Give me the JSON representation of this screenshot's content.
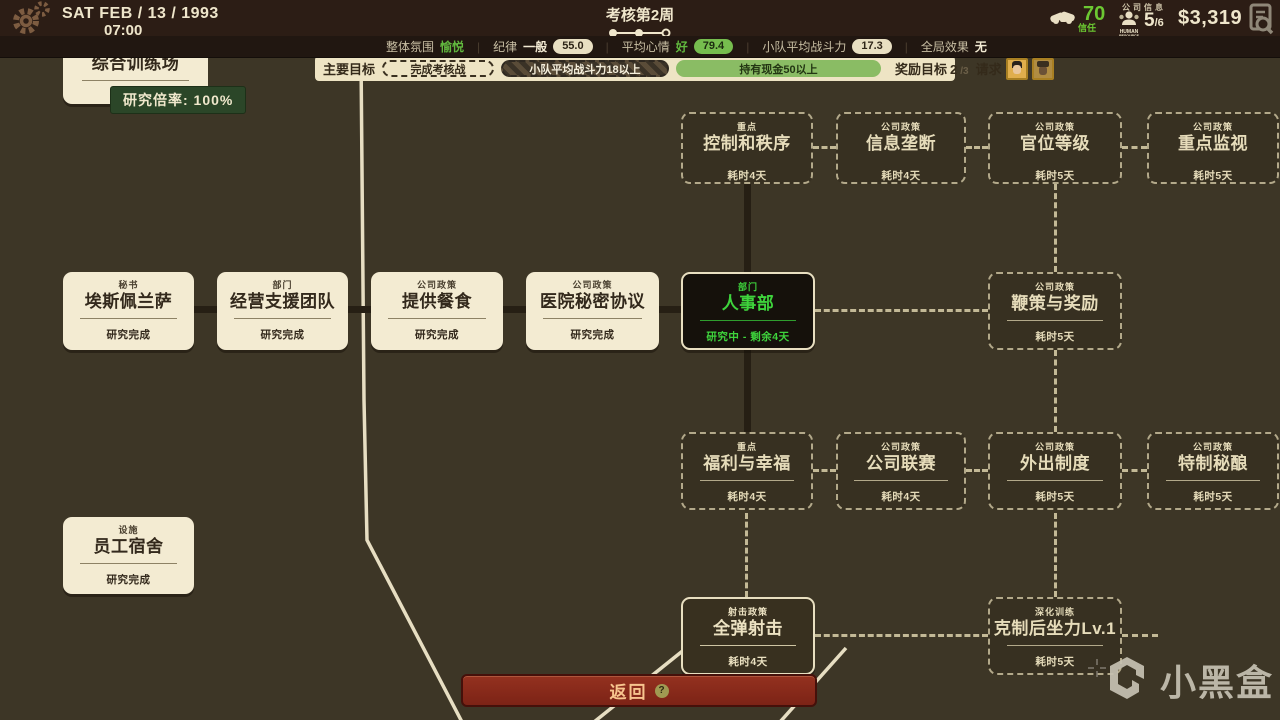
{
  "topbar": {
    "date": "SAT  FEB / 13 / 1993",
    "time": "07:00",
    "week_title": "考核第2周",
    "trust_value": "70",
    "trust_label": "信任",
    "company_info_label": "公司信息",
    "hr_icon_line1": "HUMAN",
    "hr_icon_line2": "RESOURCE",
    "hr_current": "5",
    "hr_max": "/6",
    "money": "$3,319"
  },
  "statsbar": {
    "items": [
      {
        "label": "整体氛围",
        "value": "愉悦",
        "value_class": "green"
      },
      {
        "label": "纪律",
        "value": "一般",
        "value_class": "white",
        "pill": "55.0",
        "pill_class": "cream"
      },
      {
        "label": "平均心情",
        "value": "好",
        "value_class": "green",
        "pill": "79.4",
        "pill_class": "green"
      },
      {
        "label": "小队平均战斗力",
        "pill": "17.3",
        "pill_class": "cream"
      },
      {
        "label": "全局效果",
        "value": "无",
        "value_class": "white"
      }
    ]
  },
  "objectives": {
    "title": "主要目标",
    "goals": [
      {
        "text": "完成考核战",
        "style": "dashed"
      },
      {
        "text": "小队平均战斗力18以上",
        "style": "hatched"
      },
      {
        "text": "持有现金50以上",
        "style": "green"
      }
    ],
    "reward_label": "奖励目标",
    "reward_current": "2",
    "reward_total": "/3",
    "request_label": "请求"
  },
  "tooltip": {
    "text": "研究倍率: 100%"
  },
  "nodes": [
    {
      "id": "zonghe-xunlianchang",
      "category": "",
      "title": "综合训练场",
      "status": "研究完成",
      "state": "done",
      "x": 63,
      "y": 34,
      "w": 145,
      "h": 70
    },
    {
      "id": "kongzhi-he-zhixu",
      "category": "重点",
      "title": "控制和秩序",
      "status": "耗时4天",
      "state": "locked",
      "x": 681,
      "y": 112,
      "w": 132,
      "h": 72
    },
    {
      "id": "xinxi-longduan",
      "category": "公司政策",
      "title": "信息垄断",
      "status": "耗时4天",
      "state": "locked",
      "x": 836,
      "y": 112,
      "w": 130,
      "h": 72
    },
    {
      "id": "guanwei-dengji",
      "category": "公司政策",
      "title": "官位等级",
      "status": "耗时5天",
      "state": "locked",
      "x": 988,
      "y": 112,
      "w": 134,
      "h": 72
    },
    {
      "id": "zhongdian-jianshi",
      "category": "公司政策",
      "title": "重点监视",
      "status": "耗时5天",
      "state": "locked",
      "x": 1147,
      "y": 112,
      "w": 132,
      "h": 72
    },
    {
      "id": "aisipeilansa",
      "category": "秘书",
      "title": "埃斯佩兰萨",
      "status": "研究完成",
      "state": "done",
      "x": 63,
      "y": 272,
      "w": 131,
      "h": 78
    },
    {
      "id": "jingying-zhiyuan-tuandui",
      "category": "部门",
      "title": "经营支援团队",
      "status": "研究完成",
      "state": "done",
      "x": 217,
      "y": 272,
      "w": 131,
      "h": 78
    },
    {
      "id": "tigong-canshi",
      "category": "公司政策",
      "title": "提供餐食",
      "status": "研究完成",
      "state": "done",
      "x": 371,
      "y": 272,
      "w": 132,
      "h": 78
    },
    {
      "id": "yiyuan-mimi-xieyi",
      "category": "公司政策",
      "title": "医院秘密协议",
      "status": "研究完成",
      "state": "done",
      "x": 526,
      "y": 272,
      "w": 133,
      "h": 78
    },
    {
      "id": "renshibu",
      "category": "部门",
      "title": "人事部",
      "status": "研究中 - 剩余4天",
      "state": "active",
      "x": 681,
      "y": 272,
      "w": 134,
      "h": 78
    },
    {
      "id": "biance-yu-jiangli",
      "category": "公司政策",
      "title": "鞭策与奖励",
      "status": "耗时5天",
      "state": "locked",
      "x": 988,
      "y": 272,
      "w": 134,
      "h": 78
    },
    {
      "id": "fuli-yu-xingfu",
      "category": "重点",
      "title": "福利与幸福",
      "status": "耗时4天",
      "state": "locked",
      "x": 681,
      "y": 432,
      "w": 132,
      "h": 78
    },
    {
      "id": "gongsi-liansai",
      "category": "公司政策",
      "title": "公司联赛",
      "status": "耗时4天",
      "state": "locked",
      "x": 836,
      "y": 432,
      "w": 130,
      "h": 78
    },
    {
      "id": "waichu-zhidu",
      "category": "公司政策",
      "title": "外出制度",
      "status": "耗时5天",
      "state": "locked",
      "x": 988,
      "y": 432,
      "w": 134,
      "h": 78
    },
    {
      "id": "tezhi-miniang",
      "category": "公司政策",
      "title": "特制秘酿",
      "status": "耗时5天",
      "state": "locked",
      "x": 1147,
      "y": 432,
      "w": 132,
      "h": 78
    },
    {
      "id": "yuangong-sushe",
      "category": "设施",
      "title": "员工宿舍",
      "status": "研究完成",
      "state": "done",
      "x": 63,
      "y": 517,
      "w": 131,
      "h": 77
    },
    {
      "id": "quandan-sheji",
      "category": "射击政策",
      "title": "全弹射击",
      "status": "耗时4天",
      "state": "available",
      "x": 681,
      "y": 597,
      "w": 134,
      "h": 78
    },
    {
      "id": "kezhi-houzuoli-lv1",
      "category": "深化训练",
      "title": "克制后坐力Lv.1",
      "status": "耗时5天",
      "state": "locked",
      "x": 988,
      "y": 597,
      "w": 134,
      "h": 78
    }
  ],
  "connectors": [
    {
      "o": "h",
      "x": 194,
      "y": 306,
      "len": 23,
      "style": "solid"
    },
    {
      "o": "h",
      "x": 348,
      "y": 306,
      "len": 23,
      "style": "solid"
    },
    {
      "o": "h",
      "x": 503,
      "y": 306,
      "len": 23,
      "style": "solid"
    },
    {
      "o": "h",
      "x": 659,
      "y": 306,
      "len": 22,
      "style": "solid"
    },
    {
      "o": "v",
      "x": 744,
      "y": 184,
      "len": 88,
      "style": "solid"
    },
    {
      "o": "v",
      "x": 744,
      "y": 350,
      "len": 82,
      "style": "solid"
    },
    {
      "o": "h",
      "x": 813,
      "y": 146,
      "len": 23,
      "style": "dashed"
    },
    {
      "o": "h",
      "x": 966,
      "y": 146,
      "len": 22,
      "style": "dashed"
    },
    {
      "o": "h",
      "x": 1122,
      "y": 146,
      "len": 25,
      "style": "dashed"
    },
    {
      "o": "h",
      "x": 815,
      "y": 309,
      "len": 173,
      "style": "dashed"
    },
    {
      "o": "h",
      "x": 813,
      "y": 469,
      "len": 23,
      "style": "dashed"
    },
    {
      "o": "h",
      "x": 966,
      "y": 469,
      "len": 22,
      "style": "dashed"
    },
    {
      "o": "h",
      "x": 1122,
      "y": 469,
      "len": 25,
      "style": "dashed"
    },
    {
      "o": "h",
      "x": 815,
      "y": 634,
      "len": 173,
      "style": "dashed"
    },
    {
      "o": "h",
      "x": 1122,
      "y": 634,
      "len": 36,
      "style": "dashed"
    },
    {
      "o": "v",
      "x": 1054,
      "y": 184,
      "len": 88,
      "style": "dashed"
    },
    {
      "o": "v",
      "x": 1054,
      "y": 350,
      "len": 82,
      "style": "dashed"
    },
    {
      "o": "v",
      "x": 1054,
      "y": 513,
      "len": 84,
      "style": "dashed"
    },
    {
      "o": "v",
      "x": 745,
      "y": 513,
      "len": 84,
      "style": "dashed"
    }
  ],
  "map": {
    "roads": [
      "361,56 364,400 367,540 462,722",
      "690,645 594,722",
      "846,648 780,722"
    ]
  },
  "back_button": {
    "label": "返回",
    "help": "?"
  },
  "watermark": {
    "text": "小黑盒"
  }
}
